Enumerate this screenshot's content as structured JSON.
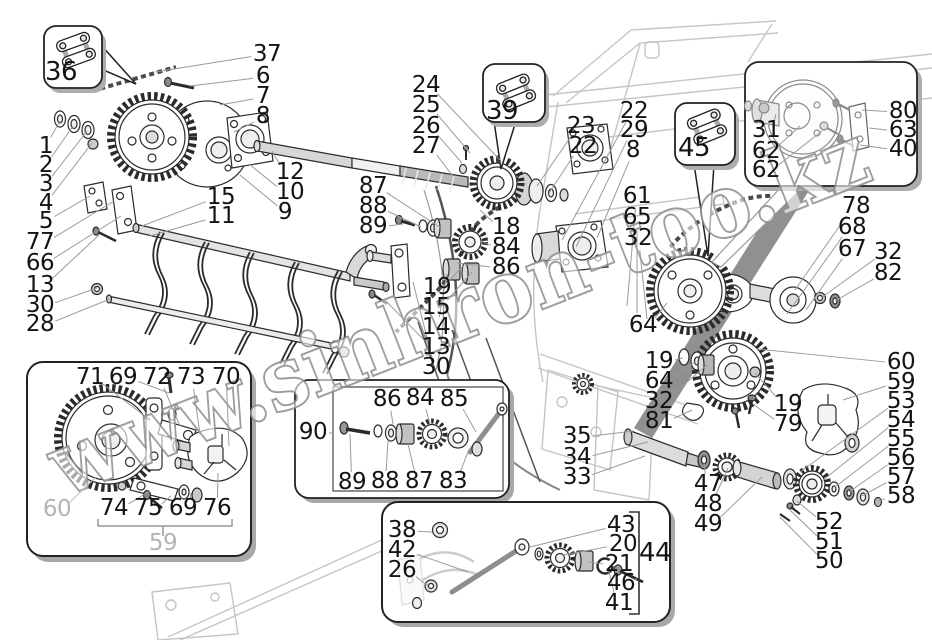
{
  "watermark": "www.sinhron-too.kz",
  "accent_colors": {
    "line_art": "#2b2b2b",
    "frame": "#c5c5c5",
    "leader": "#9b9b9b",
    "gray_label": "#b4b4b4",
    "watermark_stroke": "#8d8d8d"
  },
  "callout_boxes": [
    {
      "id": "36",
      "icon": "chain-link-icon"
    },
    {
      "id": "39",
      "icon": "chain-link-icon"
    },
    {
      "id": "45",
      "icon": "chain-link-icon"
    },
    {
      "id": "pulley-detail",
      "labels_left": [
        "31",
        "62",
        "62"
      ],
      "labels_right": [
        "80",
        "63",
        "40"
      ]
    },
    {
      "id": "crank-detail",
      "labels_top": [
        "71",
        "69",
        "72",
        "73",
        "70"
      ],
      "labels_bottom": [
        "74",
        "75",
        "69",
        "76"
      ],
      "gray_labels": [
        "60",
        "59"
      ]
    },
    {
      "id": "90",
      "labels_top": [
        "86",
        "84",
        "85"
      ],
      "labels_bottom": [
        "89",
        "88",
        "87",
        "83"
      ]
    },
    {
      "id": "44",
      "labels_left": [
        "38",
        "42",
        "26"
      ],
      "labels_right": [
        "43",
        "20",
        "21",
        "46",
        "41"
      ]
    }
  ],
  "labels": [
    {
      "t": "36",
      "x": 61,
      "y": 73,
      "fs": "big"
    },
    {
      "t": "37",
      "x": 267,
      "y": 55,
      "tx": 155,
      "ty": 72
    },
    {
      "t": "6",
      "x": 263,
      "y": 77,
      "tx": 190,
      "ty": 86
    },
    {
      "t": "7",
      "x": 263,
      "y": 97,
      "tx": 220,
      "ty": 105
    },
    {
      "t": "8",
      "x": 263,
      "y": 117,
      "tx": 234,
      "ty": 132
    },
    {
      "t": "1",
      "x": 46,
      "y": 147,
      "tx": 60,
      "ty": 121
    },
    {
      "t": "2",
      "x": 46,
      "y": 166,
      "tx": 73,
      "ty": 126
    },
    {
      "t": "3",
      "x": 46,
      "y": 185,
      "tx": 87,
      "ty": 131
    },
    {
      "t": "4",
      "x": 46,
      "y": 204,
      "tx": 92,
      "ty": 143
    },
    {
      "t": "5",
      "x": 46,
      "y": 222,
      "tx": 90,
      "ty": 196
    },
    {
      "t": "77",
      "x": 40,
      "y": 243,
      "tx": 114,
      "ty": 201
    },
    {
      "t": "66",
      "x": 40,
      "y": 264,
      "tx": 121,
      "ty": 216
    },
    {
      "t": "13",
      "x": 40,
      "y": 286,
      "tx": 100,
      "ty": 234
    },
    {
      "t": "30",
      "x": 40,
      "y": 306,
      "tx": 97,
      "ty": 288
    },
    {
      "t": "28",
      "x": 40,
      "y": 325,
      "tx": 110,
      "ty": 299
    },
    {
      "t": "12",
      "x": 290,
      "y": 173,
      "tx": 272,
      "ty": 151
    },
    {
      "t": "10",
      "x": 290,
      "y": 193,
      "tx": 249,
      "ty": 164
    },
    {
      "t": "9",
      "x": 285,
      "y": 213,
      "tx": 240,
      "ty": 175
    },
    {
      "t": "15",
      "x": 221,
      "y": 198,
      "tx": 142,
      "ty": 226
    },
    {
      "t": "11",
      "x": 221,
      "y": 217,
      "tx": 150,
      "ty": 236
    },
    {
      "t": "24",
      "x": 426,
      "y": 86,
      "tx": 500,
      "ty": 160
    },
    {
      "t": "25",
      "x": 426,
      "y": 106,
      "tx": 470,
      "ty": 153
    },
    {
      "t": "26",
      "x": 426,
      "y": 127,
      "tx": 462,
      "ty": 163
    },
    {
      "t": "27",
      "x": 426,
      "y": 147,
      "tx": 452,
      "ty": 175
    },
    {
      "t": "39",
      "x": 502,
      "y": 112,
      "fs": "big"
    },
    {
      "t": "23",
      "x": 581,
      "y": 127,
      "tx": 537,
      "ty": 186
    },
    {
      "t": "22",
      "x": 583,
      "y": 147,
      "tx": 549,
      "ty": 193
    },
    {
      "t": "22",
      "x": 634,
      "y": 112,
      "tx": 562,
      "ty": 240
    },
    {
      "t": "29",
      "x": 634,
      "y": 131,
      "tx": 576,
      "ty": 247
    },
    {
      "t": "8",
      "x": 633,
      "y": 151,
      "tx": 597,
      "ty": 238
    },
    {
      "t": "61",
      "x": 637,
      "y": 197,
      "tx": 627,
      "ty": 306
    },
    {
      "t": "65",
      "x": 637,
      "y": 218,
      "tx": 637,
      "ty": 313
    },
    {
      "t": "32",
      "x": 638,
      "y": 239,
      "tx": 647,
      "ty": 319
    },
    {
      "t": "45",
      "x": 694,
      "y": 149,
      "fs": "big"
    },
    {
      "t": "31",
      "x": 766,
      "y": 131,
      "tx": 776,
      "ty": 114
    },
    {
      "t": "62",
      "x": 766,
      "y": 152,
      "tx": 800,
      "ty": 126
    },
    {
      "t": "62",
      "x": 766,
      "y": 171,
      "tx": 822,
      "ty": 131
    },
    {
      "t": "80",
      "x": 903,
      "y": 112,
      "tx": 862,
      "ty": 110
    },
    {
      "t": "63",
      "x": 903,
      "y": 131,
      "tx": 869,
      "ty": 128
    },
    {
      "t": "40",
      "x": 903,
      "y": 150,
      "tx": 860,
      "ty": 145
    },
    {
      "t": "87",
      "x": 373,
      "y": 187,
      "tx": 441,
      "ty": 228
    },
    {
      "t": "88",
      "x": 373,
      "y": 207,
      "tx": 421,
      "ty": 227
    },
    {
      "t": "89",
      "x": 373,
      "y": 227,
      "tx": 403,
      "ty": 224
    },
    {
      "t": "18",
      "x": 506,
      "y": 228,
      "tx": 480,
      "ty": 210
    },
    {
      "t": "84",
      "x": 506,
      "y": 248,
      "tx": 481,
      "ty": 241
    },
    {
      "t": "86",
      "x": 506,
      "y": 268,
      "tx": 457,
      "ty": 263
    },
    {
      "t": "19",
      "x": 437,
      "y": 288,
      "tx": 463,
      "ty": 266
    },
    {
      "t": "15",
      "x": 436,
      "y": 308,
      "tx": 472,
      "ty": 272
    },
    {
      "t": "14",
      "x": 436,
      "y": 328,
      "tx": 447,
      "ty": 274
    },
    {
      "t": "13",
      "x": 436,
      "y": 348,
      "tx": 385,
      "ty": 300
    },
    {
      "t": "30",
      "x": 436,
      "y": 368,
      "tx": 413,
      "ty": 282
    },
    {
      "t": "78",
      "x": 856,
      "y": 207,
      "tx": 795,
      "ty": 290
    },
    {
      "t": "68",
      "x": 852,
      "y": 228,
      "tx": 787,
      "ty": 314
    },
    {
      "t": "67",
      "x": 852,
      "y": 250,
      "tx": 806,
      "ty": 310
    },
    {
      "t": "32",
      "x": 888,
      "y": 253,
      "tx": 821,
      "ty": 298
    },
    {
      "t": "82",
      "x": 888,
      "y": 274,
      "tx": 835,
      "ty": 301
    },
    {
      "t": "64",
      "x": 643,
      "y": 326,
      "tx": 667,
      "ty": 303
    },
    {
      "t": "19",
      "x": 659,
      "y": 362,
      "tx": 683,
      "ty": 358
    },
    {
      "t": "64",
      "x": 659,
      "y": 382,
      "tx": 695,
      "ty": 362
    },
    {
      "t": "32",
      "x": 659,
      "y": 402,
      "tx": 707,
      "ty": 365
    },
    {
      "t": "81",
      "x": 659,
      "y": 422,
      "tx": 692,
      "ty": 410
    },
    {
      "t": "19",
      "x": 788,
      "y": 405,
      "tx": 755,
      "ty": 373
    },
    {
      "t": "79",
      "x": 788,
      "y": 425,
      "tx": 753,
      "ty": 404
    },
    {
      "t": "60",
      "x": 901,
      "y": 363,
      "tx": 757,
      "ty": 349
    },
    {
      "t": "59",
      "x": 901,
      "y": 383,
      "tx": 843,
      "ty": 400
    },
    {
      "t": "53",
      "x": 901,
      "y": 402,
      "tx": 800,
      "ty": 472
    },
    {
      "t": "54",
      "x": 901,
      "y": 421,
      "tx": 822,
      "ty": 481
    },
    {
      "t": "55",
      "x": 901,
      "y": 440,
      "tx": 835,
      "ty": 487
    },
    {
      "t": "56",
      "x": 901,
      "y": 459,
      "tx": 849,
      "ty": 492
    },
    {
      "t": "57",
      "x": 901,
      "y": 478,
      "tx": 862,
      "ty": 496
    },
    {
      "t": "58",
      "x": 901,
      "y": 497,
      "tx": 877,
      "ty": 501
    },
    {
      "t": "35",
      "x": 577,
      "y": 437,
      "tx": 634,
      "ty": 431
    },
    {
      "t": "34",
      "x": 577,
      "y": 458,
      "tx": 648,
      "ty": 442
    },
    {
      "t": "33",
      "x": 577,
      "y": 478,
      "tx": 645,
      "ty": 456
    },
    {
      "t": "47",
      "x": 708,
      "y": 485,
      "tx": 704,
      "ty": 462
    },
    {
      "t": "48",
      "x": 708,
      "y": 505,
      "tx": 728,
      "ty": 468
    },
    {
      "t": "49",
      "x": 708,
      "y": 525,
      "tx": 762,
      "ty": 477
    },
    {
      "t": "52",
      "x": 829,
      "y": 523,
      "tx": 797,
      "ty": 501
    },
    {
      "t": "51",
      "x": 829,
      "y": 543,
      "tx": 789,
      "ty": 509
    },
    {
      "t": "50",
      "x": 829,
      "y": 562,
      "tx": 780,
      "ty": 517
    },
    {
      "t": "71",
      "x": 90,
      "y": 378,
      "tx": 150,
      "ty": 420
    },
    {
      "t": "69",
      "x": 123,
      "y": 378,
      "tx": 169,
      "ty": 393
    },
    {
      "t": "72",
      "x": 157,
      "y": 378,
      "tx": 180,
      "ty": 426
    },
    {
      "t": "73",
      "x": 191,
      "y": 378,
      "tx": 200,
      "ty": 434
    },
    {
      "t": "70",
      "x": 226,
      "y": 378,
      "tx": 229,
      "ty": 446
    },
    {
      "t": "74",
      "x": 114,
      "y": 509,
      "tx": 150,
      "ty": 491
    },
    {
      "t": "75",
      "x": 148,
      "y": 509,
      "tx": 171,
      "ty": 496
    },
    {
      "t": "69",
      "x": 183,
      "y": 509,
      "tx": 191,
      "ty": 493
    },
    {
      "t": "76",
      "x": 217,
      "y": 509,
      "tx": 218,
      "ty": 473
    },
    {
      "t": "60",
      "x": 57,
      "y": 510,
      "g": 1,
      "tx": 96,
      "ty": 477
    },
    {
      "t": "59",
      "x": 163,
      "y": 544,
      "g": 1
    },
    {
      "t": "90",
      "x": 313,
      "y": 433,
      "tx": 332,
      "ty": 433
    },
    {
      "t": "86",
      "x": 387,
      "y": 400,
      "tx": 393,
      "ty": 424
    },
    {
      "t": "84",
      "x": 420,
      "y": 399,
      "tx": 430,
      "ty": 424
    },
    {
      "t": "85",
      "x": 454,
      "y": 400,
      "tx": 476,
      "ty": 432
    },
    {
      "t": "89",
      "x": 352,
      "y": 483,
      "tx": 350,
      "ty": 434
    },
    {
      "t": "88",
      "x": 385,
      "y": 482,
      "tx": 388,
      "ty": 440
    },
    {
      "t": "87",
      "x": 419,
      "y": 482,
      "tx": 408,
      "ty": 444
    },
    {
      "t": "83",
      "x": 453,
      "y": 482,
      "tx": 468,
      "ty": 452
    },
    {
      "t": "38",
      "x": 402,
      "y": 531,
      "tx": 432,
      "ty": 532
    },
    {
      "t": "42",
      "x": 402,
      "y": 551,
      "tx": 468,
      "ty": 572
    },
    {
      "t": "26",
      "x": 402,
      "y": 571,
      "tx": 428,
      "ty": 586
    },
    {
      "t": "43",
      "x": 621,
      "y": 526,
      "tx": 530,
      "ty": 547
    },
    {
      "t": "20",
      "x": 623,
      "y": 545,
      "tx": 563,
      "ty": 555
    },
    {
      "t": "21",
      "x": 619,
      "y": 565,
      "tx": 588,
      "ty": 562
    },
    {
      "t": "46",
      "x": 621,
      "y": 584,
      "tx": 636,
      "ty": 578
    },
    {
      "t": "41",
      "x": 619,
      "y": 604,
      "tx": 608,
      "ty": 568
    },
    {
      "t": "44",
      "x": 655,
      "y": 554,
      "fs": "big"
    }
  ]
}
